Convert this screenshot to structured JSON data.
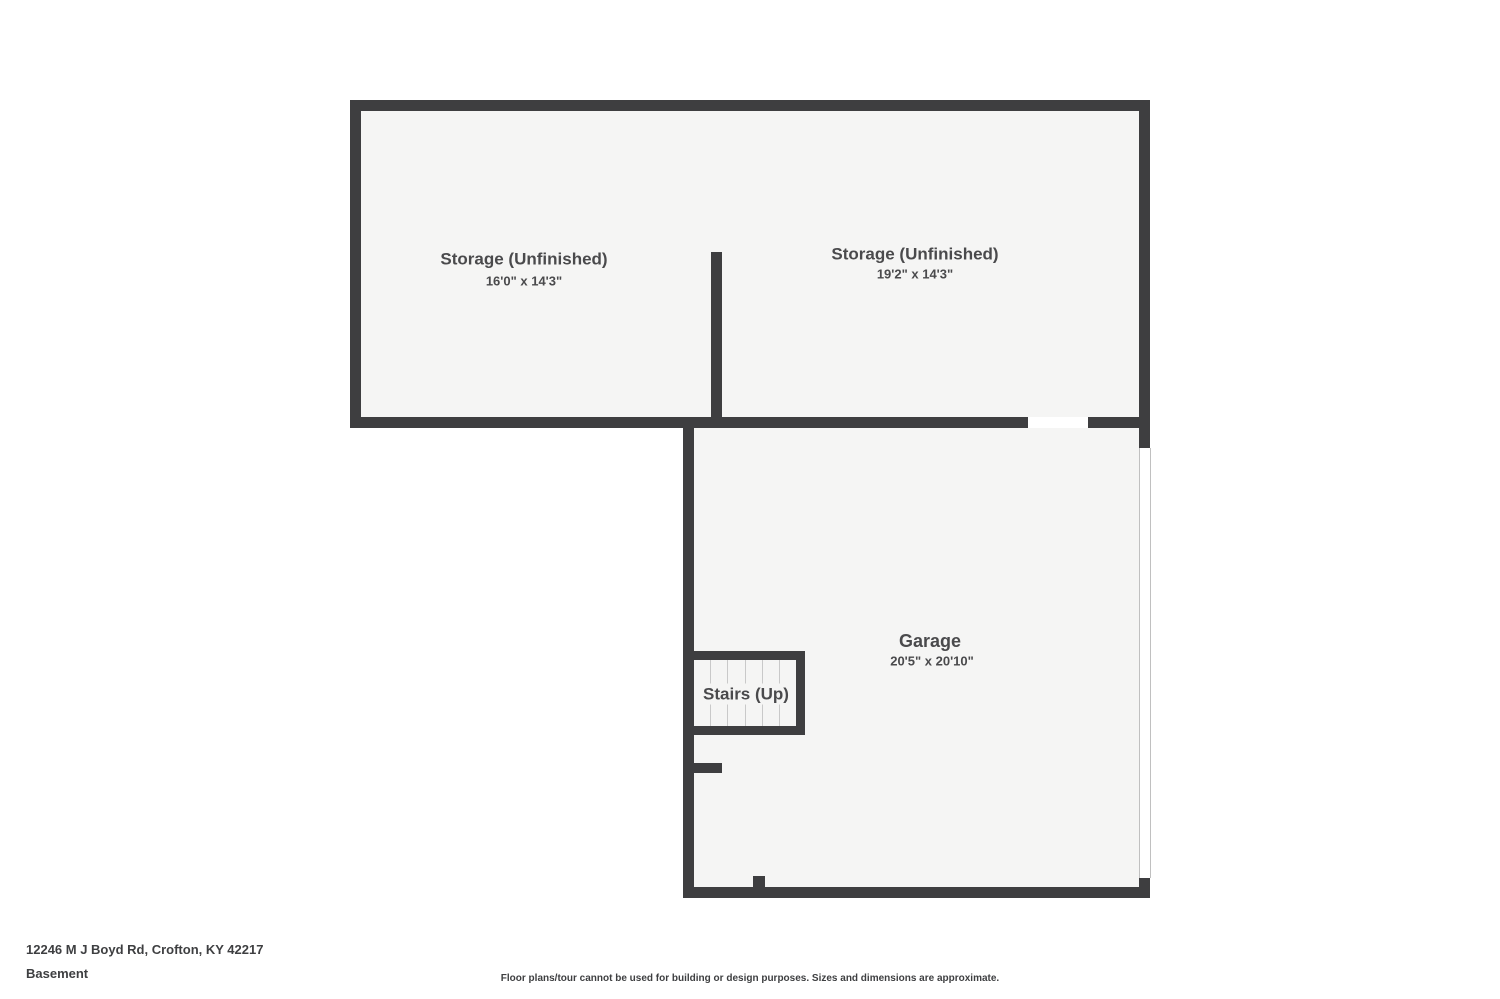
{
  "colors": {
    "wall": "#3e3e40",
    "floor": "#f5f5f4",
    "label": "#4a4a4c",
    "footer": "#3e3f41",
    "tread_line": "#c9c9c9",
    "door_line": "#c0c0c0"
  },
  "rooms": {
    "storage_left": {
      "name": "Storage (Unfinished)",
      "dimensions": "16'0\" x 14'3\""
    },
    "storage_right": {
      "name": "Storage (Unfinished)",
      "dimensions": "19'2\" x 14'3\""
    },
    "garage": {
      "name": "Garage",
      "dimensions": "20'5\" x 20'10\""
    },
    "stairs": {
      "name": "Stairs (Up)"
    }
  },
  "footer": {
    "address": "12246 M J Boyd Rd, Crofton, KY 42217",
    "floor_name": "Basement",
    "disclaimer": "Floor plans/tour cannot be used for building or design purposes. Sizes and dimensions are approximate."
  }
}
